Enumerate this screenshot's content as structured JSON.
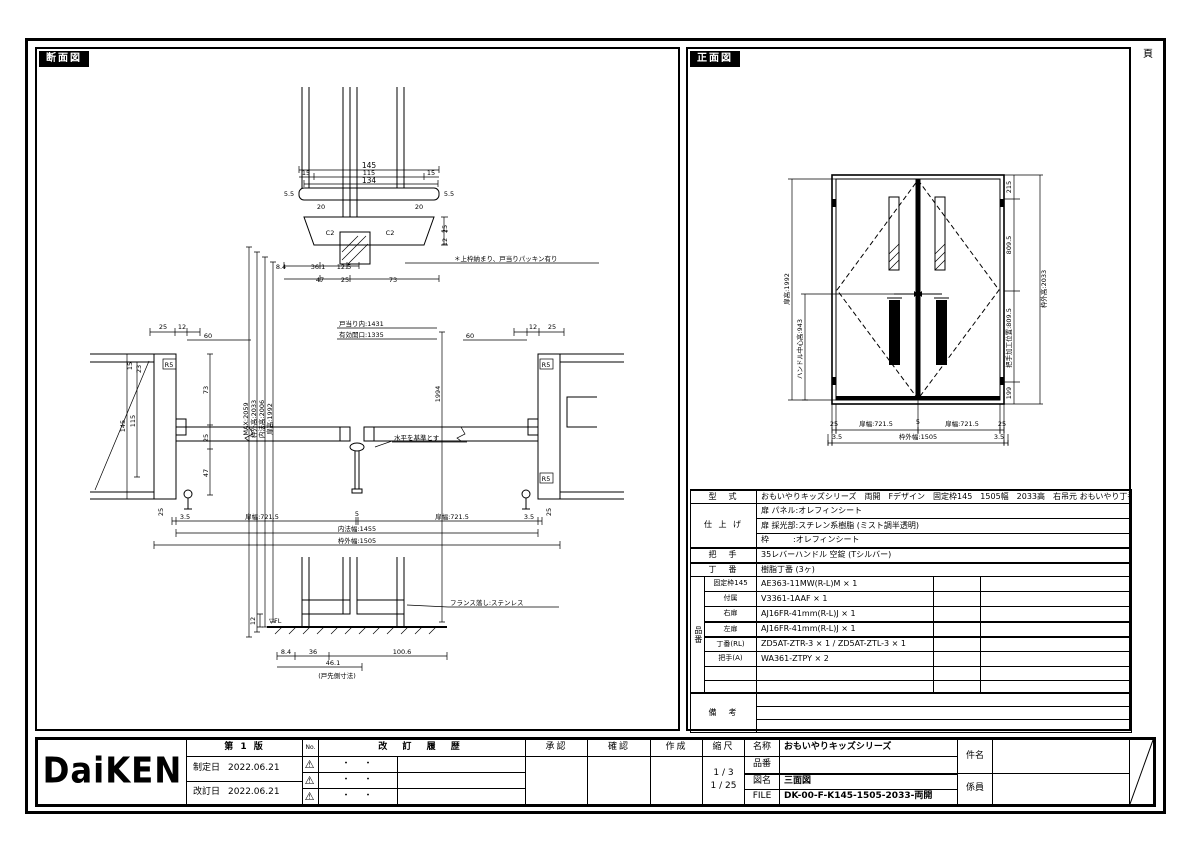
{
  "page": {
    "page_label": "頁"
  },
  "brand": {
    "logo": "DaiKEN"
  },
  "section": {
    "title": "断面図",
    "top": {
      "d145": "145",
      "d115": "115",
      "d134": "134",
      "d15l": "15",
      "d15r": "15",
      "d55l": "5.5",
      "d55r": "5.5",
      "d20l": "20",
      "d20r": "20",
      "c2l": "C2",
      "c2r": "C2",
      "d25": "25",
      "d12": "12",
      "d84": "8.4",
      "d361": "36.1",
      "d125": "12.5",
      "d47": "47",
      "d25b": "25",
      "d73": "73",
      "note": "＊上枠納まり、戸当りパッキン有り"
    },
    "mid": {
      "t25l": "25",
      "t12l": "12",
      "t60l": "60",
      "t60r": "60",
      "t12r": "12",
      "t25r": "25",
      "w1431": "戸当り内:1431",
      "w1335": "有効開口:1335",
      "v2059": "MAX:2059",
      "v2033": "枠外高:2033",
      "v2006": "内法高:2006",
      "v1992": "扉高:1992",
      "v1994": "1994",
      "j15": "15",
      "j23": "23",
      "r5a": "R5",
      "r5b": "R5",
      "r5c": "R5",
      "j145": "145",
      "j115": "115",
      "j73": "73",
      "j25": "25",
      "j47": "47",
      "note": "水平を基準とす",
      "b25l": "25",
      "b25r": "25",
      "b35l": "3.5",
      "b35r": "3.5",
      "bw1": "扉幅:721.5",
      "b5": "5",
      "bw2": "扉幅:721.5",
      "b1455": "内法幅:1455",
      "b1505": "枠外幅:1505"
    },
    "bottom": {
      "fl": "▽FL",
      "note": "フランス落し:ステンレス",
      "d12": "12",
      "d84": "8.4",
      "d36": "36",
      "d461": "46.1",
      "d1006": "100.6",
      "dnote": "(戸先側寸法)"
    }
  },
  "front": {
    "title": "正面図",
    "left1992": "扉高:1992",
    "left943": "ハンドル中心高:943",
    "r215": "215",
    "r8095a": "809.5",
    "r8095b": "把手加工位置:809.5",
    "r199": "199",
    "r2033": "枠外高:2033",
    "b25l": "25",
    "bw1": "扉幅:721.5",
    "b5": "5",
    "bw2": "扉幅:721.5",
    "b25r": "25",
    "b35l": "3.5",
    "b1505": "枠外幅:1505",
    "b35r": "3.5"
  },
  "spec": {
    "katashiki_label": "型　式",
    "katashiki": "おもいやりキッズシリーズ　両開　Fデザイン　固定枠145　1505幅　2033高　右吊元 おもいやり丁番",
    "shiage_label": "仕 上 げ",
    "shiage1": "扉 パネル:オレフィンシート",
    "shiage2": "扉 採光部:スチレン系樹脂 (ミスト調半透明)",
    "shiage3": "枠　　　:オレフィンシート",
    "totte_label": "把　手",
    "totte": "35レバーハンドル 空錠 (Tシルバー)",
    "choban_label": "丁　番",
    "choban": "樹脂丁番 (3ヶ)",
    "hinban_label": "品番",
    "parts": [
      {
        "name": "固定枠145",
        "code": "AE363-11MW(R-L)M × 1"
      },
      {
        "name": "付属",
        "code": "V3361-1AAF × 1"
      },
      {
        "name": "右扉",
        "code": "AJ16FR-41mm(R-L)J × 1"
      },
      {
        "name": "左扉",
        "code": "AJ16FR-41mm(R-L)J × 1"
      },
      {
        "name": "丁番(RL)",
        "code": "ZD5AT-ZTR-3 × 1 / ZD5AT-ZTL-3 × 1"
      },
      {
        "name": "把手(A)",
        "code": "WA361-ZTPY × 2"
      },
      {
        "name": "",
        "code": ""
      },
      {
        "name": "",
        "code": ""
      }
    ],
    "biko_label": "備　考"
  },
  "titleblock": {
    "edition": "第 1 版",
    "seitei_label": "制定日",
    "seitei_date": "2022.06.21",
    "kaitei_label": "改訂日",
    "kaitei_date": "2022.06.21",
    "no_label": "No.",
    "rev_icon": "⚠",
    "history_label": "改 訂 履 歴",
    "dots": "・　・",
    "approve": "承認",
    "check": "確認",
    "create": "作成",
    "scale_label": "縮尺",
    "scale1": "1 / 3",
    "scale2": "1 / 25",
    "name_label": "名称",
    "name": "おもいやりキッズシリーズ",
    "hinban_label": "品番",
    "hinban": "",
    "zumei_label": "図名",
    "zumei": "三面図",
    "file_label": "FILE",
    "file": "DK-00-F-K145-1505-2033-両開",
    "kenmei_label": "件名",
    "kakari_label": "係員"
  }
}
